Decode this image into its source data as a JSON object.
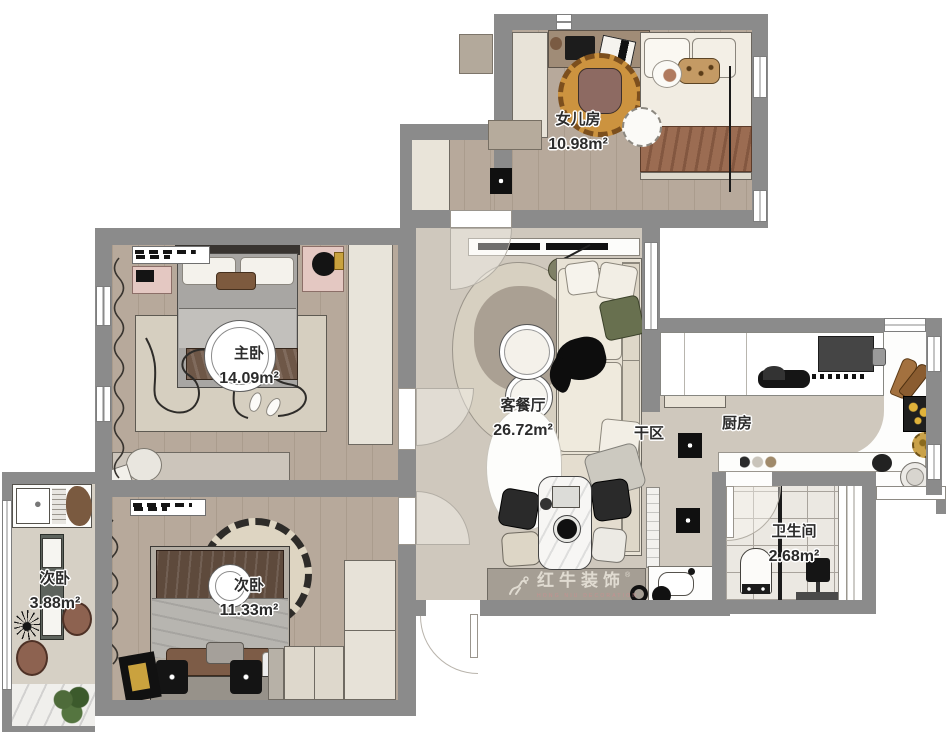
{
  "plan": {
    "rooms": [
      {
        "id": "daughter",
        "name": "女儿房",
        "area": "10.98m²"
      },
      {
        "id": "master",
        "name": "主卧",
        "area": "14.09m²"
      },
      {
        "id": "living",
        "name": "客餐厅",
        "area": "26.72m²"
      },
      {
        "id": "dry",
        "name": "干区",
        "area": ""
      },
      {
        "id": "kitchen",
        "name": "厨房",
        "area": ""
      },
      {
        "id": "bath",
        "name": "卫生间",
        "area": "2.68m²"
      },
      {
        "id": "second",
        "name": "次卧",
        "area": "11.33m²"
      },
      {
        "id": "small",
        "name": "次卧",
        "area": "3.88m²"
      }
    ],
    "watermark": {
      "reg": "®",
      "brand": "红牛装饰",
      "subtitle": "HONG NIU DECORATION"
    },
    "palette": {
      "wall": "#8b8b8b",
      "wood_floor": "#b7a99b",
      "tile_floor": "#cfc8bd",
      "bath_floor": "#ebe8e2",
      "counter": "#ffffff",
      "rug_orange": "#cc933f",
      "label_text": "#2b2b2b",
      "watermark_text": "#e7e2d8",
      "watermark_sub": "#c98f8f"
    }
  }
}
